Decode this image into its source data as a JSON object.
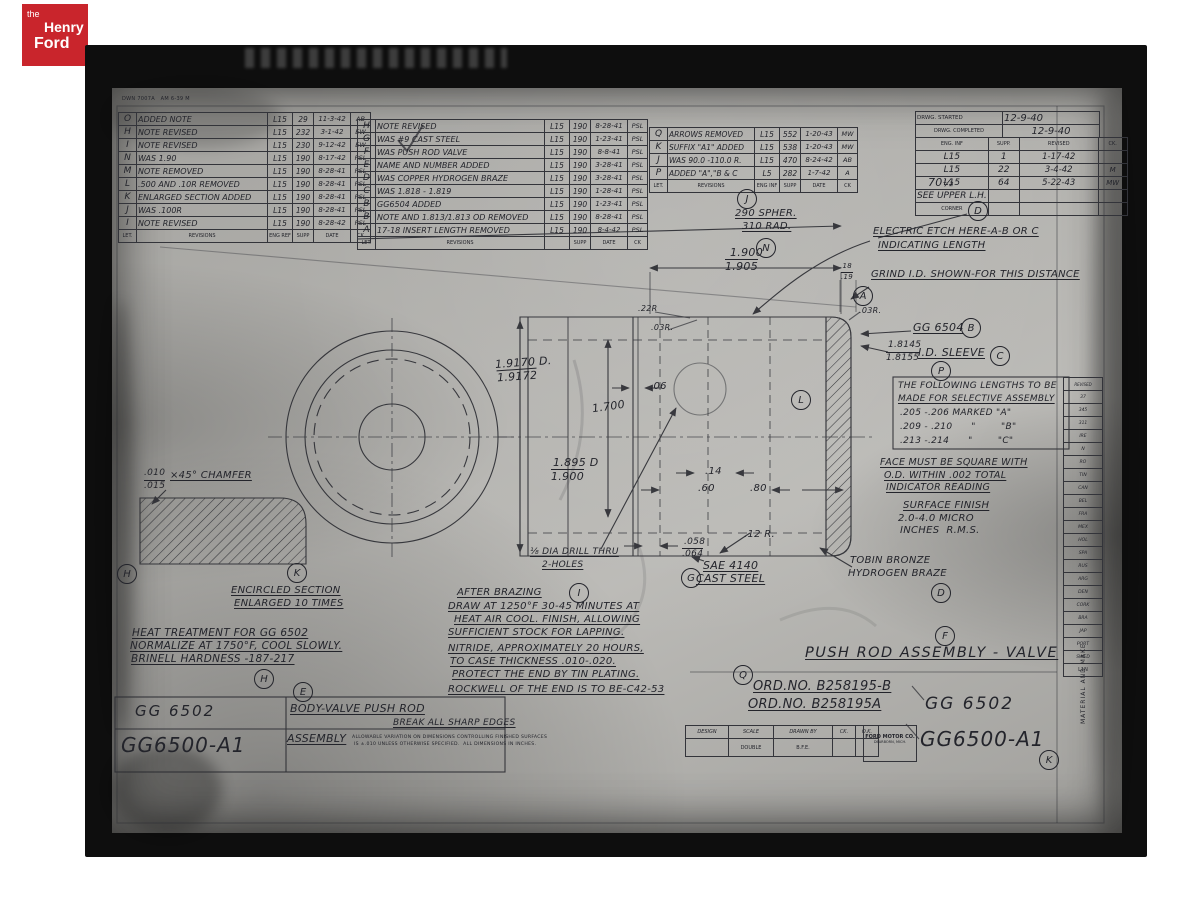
{
  "logo": {
    "the": "the",
    "henry": "Henry",
    "ford": "Ford"
  },
  "form_no": "DWN 7007A   AM 6-39 M",
  "tables": {
    "rev_left": [
      [
        "O",
        "ADDED NOTE",
        "L15",
        "29",
        "11-3-42",
        "AB"
      ],
      [
        "H",
        "NOTE REVISED",
        "L15",
        "232",
        "3-1-42",
        "EW"
      ],
      [
        "I",
        "NOTE REVISED",
        "L15",
        "230",
        "9-12-42",
        "EW"
      ],
      [
        "N",
        "WAS 1.90",
        "L15",
        "190",
        "8-17-42",
        "PSL"
      ],
      [
        "M",
        "NOTE REMOVED",
        "L15",
        "190",
        "8-28-41",
        "PSL"
      ],
      [
        "L",
        ".500 AND .10R REMOVED",
        "L15",
        "190",
        "8-28-41",
        "PSL"
      ],
      [
        "K",
        "ENLARGED SECTION ADDED",
        "L15",
        "190",
        "8-28-41",
        "PSL"
      ],
      [
        "J",
        "WAS .100R",
        "L15",
        "190",
        "8-28-41",
        "PSL"
      ],
      [
        "I",
        "NOTE REVISED",
        "L15",
        "190",
        "8-28-42",
        "PSL"
      ],
      [
        "LET.",
        "REVISIONS",
        "ENG REF",
        "SUPP",
        "DATE",
        "CK"
      ]
    ],
    "rev_mid": [
      [
        "H",
        "NOTE REVISED",
        "L15",
        "190",
        "8-28-41",
        "PSL"
      ],
      [
        "G",
        "WAS #9 CAST STEEL",
        "L15",
        "190",
        "1-23-41",
        "PSL"
      ],
      [
        "F",
        "WAS PUSH ROD VALVE",
        "L15",
        "190",
        "8-8-41",
        "PSL"
      ],
      [
        "E",
        "NAME AND NUMBER ADDED",
        "L15",
        "190",
        "3-28-41",
        "PSL"
      ],
      [
        "D",
        "WAS COPPER HYDROGEN BRAZE",
        "L15",
        "190",
        "3-28-41",
        "PSL"
      ],
      [
        "C",
        "WAS 1.818 - 1.819",
        "L15",
        "190",
        "1-28-41",
        "PSL"
      ],
      [
        "B",
        "GG6504 ADDED",
        "L15",
        "190",
        "1-23-41",
        "PSL"
      ],
      [
        "B",
        "NOTE AND 1.813/1.813 OD REMOVED",
        "L15",
        "190",
        "8-28-41",
        "PSL"
      ],
      [
        "A",
        "17-18 INSERT LENGTH REMOVED",
        "L15",
        "190",
        "8-4-42",
        "PSL"
      ],
      [
        "LET.",
        "REVISIONS",
        "",
        "SUPP",
        "DATE",
        "CK"
      ]
    ],
    "rev_right": [
      [
        "Q",
        "ARROWS REMOVED",
        "L15",
        "552",
        "1-20-43",
        "MW"
      ],
      [
        "K",
        "SUFFIX \"A1\" ADDED",
        "L15",
        "538",
        "1-20-43",
        "MW"
      ],
      [
        "J",
        "WAS 90.0 -110.0 R.",
        "L15",
        "470",
        "8-24-42",
        "AB"
      ],
      [
        "P",
        "ADDED \"A\",\"B & C",
        "L5",
        "282",
        "1-7-42",
        "A"
      ],
      [
        "LET.",
        "REVISIONS",
        "ENG INF",
        "SUPP",
        "DATE",
        "CK"
      ]
    ],
    "started_top": [
      [
        "DRWG. STARTED",
        "12-9-40"
      ],
      [
        "DRWG. COMPLETED",
        "12-9-40"
      ]
    ],
    "started_main": [
      [
        "ENG. INF",
        "SUPP.",
        "REVISED",
        "CK."
      ],
      [
        "L15",
        "1",
        "1-17-42",
        ""
      ],
      [
        "L15",
        "22",
        "3-4-42",
        "M"
      ],
      [
        "L15",
        "64",
        "5-22-43",
        "MW"
      ],
      [
        "SEE UPPER L.H.",
        "",
        "",
        ""
      ],
      [
        "CORNER",
        "",
        "",
        ""
      ]
    ],
    "edge_strip": [
      [
        "REVISED"
      ],
      [
        "37"
      ],
      [
        "345"
      ],
      [
        "311"
      ],
      [
        "IRE"
      ],
      [
        "N"
      ],
      [
        "RO"
      ],
      [
        "TIN"
      ],
      [
        "CAN"
      ],
      [
        "BEL"
      ],
      [
        "FRA"
      ],
      [
        "MEX"
      ],
      [
        "HOL"
      ],
      [
        "SPA"
      ],
      [
        "RUS"
      ],
      [
        "ARG"
      ],
      [
        "DEN"
      ],
      [
        "CORK"
      ],
      [
        "BRA"
      ],
      [
        "JAP"
      ],
      [
        "PORT"
      ],
      [
        "SWED"
      ],
      [
        "L1N"
      ]
    ],
    "title_block": [
      [
        "DESIGN",
        "SCALE",
        "DRAWN BY",
        "CK.",
        "O.K."
      ],
      [
        "",
        "DOUBLE",
        "B.F.E.",
        "",
        ""
      ]
    ]
  },
  "callouts": {
    "J": "J",
    "N": "N",
    "D1": "D",
    "A": "A",
    "B": "B",
    "C": "C",
    "P": "P",
    "L": "L",
    "G": "G",
    "I": "I",
    "D2": "D",
    "F": "F",
    "Q": "Q",
    "K1": "K",
    "K2": "K",
    "H1": "H",
    "H2": "H",
    "E": "E"
  },
  "dims": {
    "hw70": "70½",
    "sphere1": "290 SPHER.",
    "sphere2": "310 RAD.",
    "len_top1": "1.900",
    "len_top2": "1.905",
    "dia_left1": "1.9170 D.",
    "dia_left2": "1.9172",
    "d1700": "1.700",
    "dia_bore1": "1.895 D",
    "dia_bore2": "1.900",
    "d06": ".06",
    "r22": ".22R",
    "r03a": ".03R.",
    "r03b": ".03R.",
    "d18": ".18",
    "d19": ".19",
    "d14": ".14",
    "d60": ".60",
    "d80": ".80",
    "d058": ".058",
    "d064": ".064",
    "r12": ".12 R.",
    "drill1": "⅛ DIA DRILL THRU",
    "drill2": "2-HOLES",
    "chamfer1": ".010",
    "chamfer2": ".015",
    "chamfer3": "×45° CHAMFER"
  },
  "notes": {
    "etch1": "ELECTRIC ETCH HERE-A-B OR C",
    "etch2": "INDICATING LENGTH",
    "grind": "GRIND I.D. SHOWN-FOR THIS DISTANCE",
    "gg6504": "GG 6504",
    "sleeve_dim1": "1.8145",
    "sleeve_dim2": "1.8155",
    "sleeve": "I.D. SLEEVE",
    "sel1": "THE FOLLOWING LENGTHS TO BE",
    "sel2": "MADE FOR SELECTIVE ASSEMBLY",
    "sel3": ".205 -.206 MARKED \"A\"",
    "sel4": ".209 - .210      \"        \"B\"",
    "sel5": ".213 -.214      \"        \"C\"",
    "face1": "FACE MUST BE SQUARE WITH",
    "face2": "O.D. WITHIN .002 TOTAL",
    "face3": "INDICATOR READING",
    "surf1": "SURFACE FINISH",
    "surf2": "2.0-4.0 MICRO",
    "surf3": "INCHES  R.M.S.",
    "tobin1": "TOBIN BRONZE",
    "tobin2": "HYDROGEN BRAZE",
    "sae1": "SAE 4140",
    "sae2": "CAST STEEL",
    "enc1": "ENCIRCLED SECTION",
    "enc2": "ENLARGED 10 TIMES",
    "heat1": "HEAT TREATMENT FOR GG 6502",
    "heat2": "NORMALIZE AT 1750°F, COOL SLOWLY.",
    "heat3": "BRINELL HARDNESS -187-217",
    "braz0": "AFTER BRAZING",
    "braz1": "DRAW AT 1250°F 30-45 MINUTES AT",
    "braz2": "HEAT AIR COOL. FINISH, ALLOWING",
    "braz3": "SUFFICIENT STOCK FOR LAPPING.",
    "nit1": "NITRIDE, APPROXIMATELY 20 HOURS,",
    "nit2": "TO CASE THICKNESS .010-.020.",
    "nit3": "PROTECT THE END BY TIN PLATING.",
    "rock": "ROCKWELL OF THE END IS TO BE-C42-53"
  },
  "footer": {
    "part_small": "GG 6502",
    "part_big": "GG6500-A1",
    "body": "BODY-VALVE PUSH ROD",
    "assembly": "ASSEMBLY",
    "break_note": "BREAK ALL SHARP EDGES",
    "fine1": "ALLOWABLE VARIATION ON DIMENSIONS CONTROLLING FINISHED SURFACES",
    "fine2": "IS ±.010 UNLESS OTHERWISE SPECIFIED.  ALL DIMENSIONS IN INCHES.",
    "ford1": "FORD MOTOR CO.",
    "ford2": "DEARBORN, MICH.",
    "title": "PUSH ROD ASSEMBLY - VALVE",
    "ord1": "ORD.NO. B258195-B",
    "ord2": "ORD.NO. B258195A",
    "gg6502": "GG 6502",
    "gg6500": "GG6500-A1",
    "material": "MATERIAL AND MAKE"
  }
}
